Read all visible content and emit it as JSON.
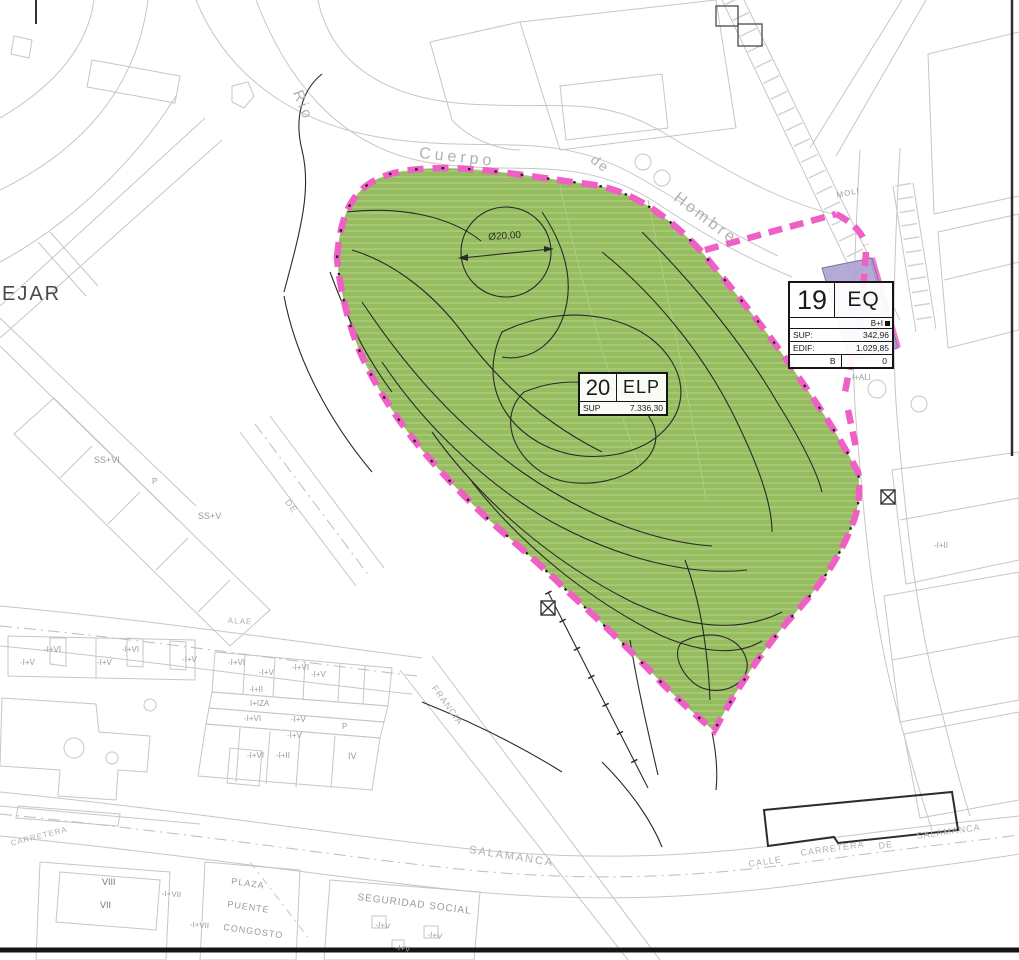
{
  "parcel_eq": {
    "number": "19",
    "code": "EQ",
    "floors": "B+I",
    "sup_label": "SUP:",
    "sup": "342,96",
    "edif_label": "EDIF:",
    "edif": "1.029,85",
    "col_b": "B",
    "col_0": "0"
  },
  "parcel_elp": {
    "number": "20",
    "code": "ELP",
    "sup_label": "SUP",
    "sup": "7.336,30"
  },
  "labels": {
    "rio": "Rio",
    "cuerpo": "Cuerpo",
    "de": "de",
    "hombre": "Hombre",
    "ejar": "EJAR",
    "diameter": "Ø20,00",
    "ss_vi": "SS+VI",
    "ss_v": "SS+V",
    "p": "P",
    "p2": "P",
    "de_road": "DE",
    "alae": "ALAE",
    "francia": "FRANCIA",
    "salamanca": "SALAMANCA",
    "calle": "CALLE",
    "carretera": "CARRETERA",
    "de2": "DE",
    "salamanca2": "SALAMANCA",
    "carretera2": "CARRETERA",
    "seguridad_social": "SEGURIDAD SOCIAL",
    "plaza": "PLAZA",
    "puente": "PUENTE",
    "congosto": "CONGOSTO",
    "viii": "VIII",
    "vii": "VII",
    "moli": "MOLI",
    "i_ali": "I+ALI",
    "iv": "IV",
    "i_ii": "-I+II"
  },
  "floor_labels": [
    "-I+VI",
    "-I+V",
    "-I+VI",
    "-I+V",
    "-I+V",
    "-I+VI",
    "-I+V",
    "-I+VI",
    "-I+V",
    "-I+II",
    "I+IZA",
    "-I+VI",
    "-I+V",
    "-I+V",
    "-I+VI",
    "-I+II",
    "-I+VII",
    "-I+VII",
    "-I+V",
    "-I+V",
    "-I+V"
  ],
  "colors": {
    "zone_green": "#95bd5f",
    "boundary_pink": "#f05fc5",
    "parcel_purple": "#a79bce"
  }
}
